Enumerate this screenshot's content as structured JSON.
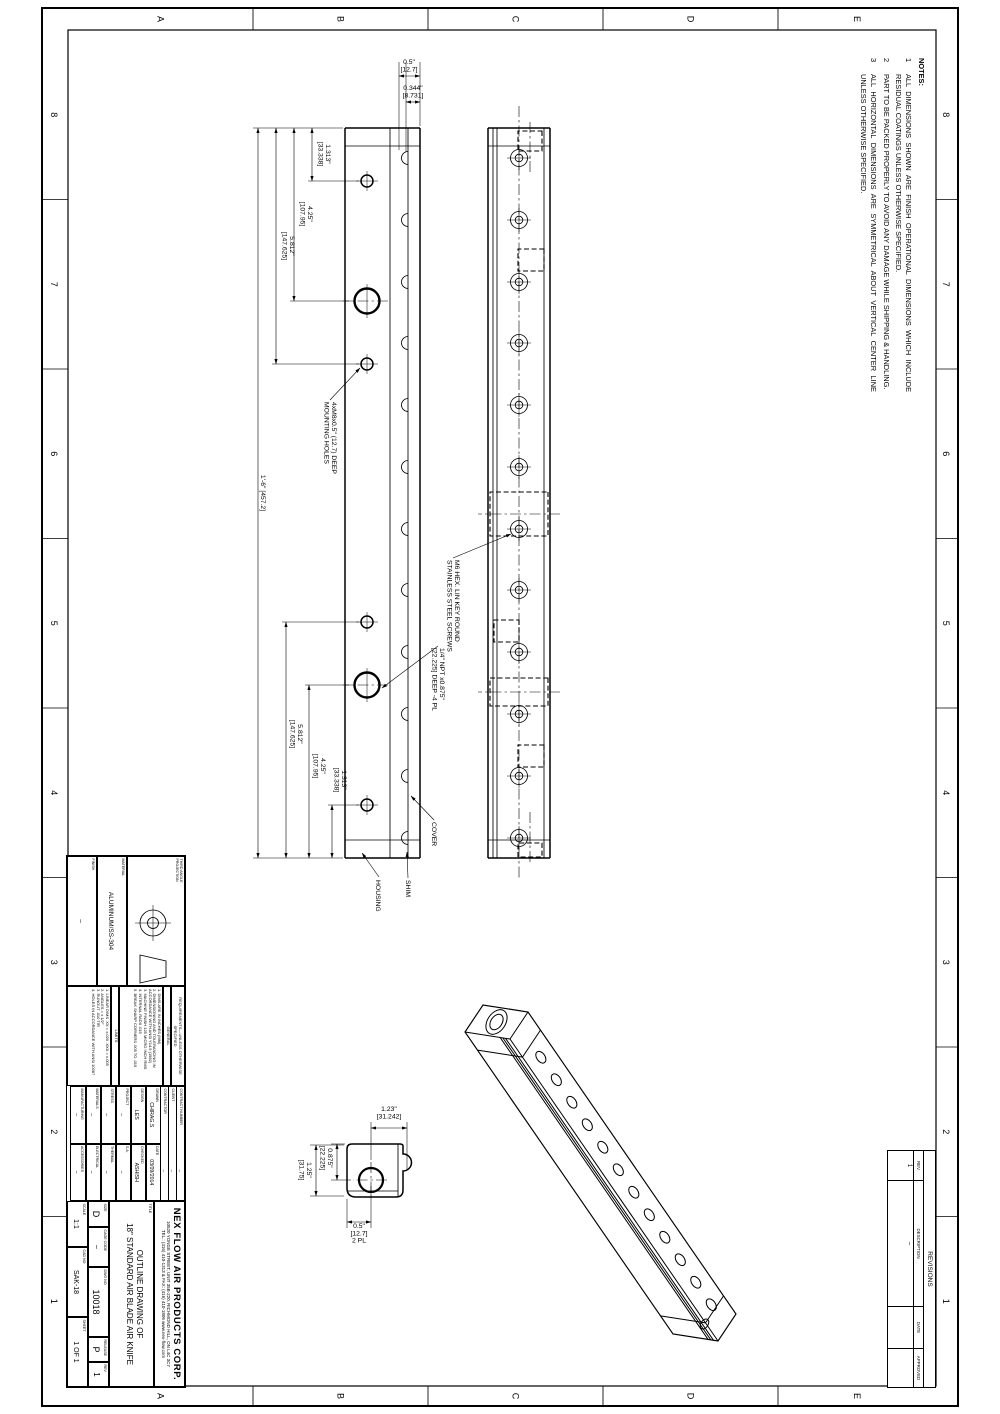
{
  "zones": {
    "columns": [
      "8",
      "7",
      "6",
      "5",
      "4",
      "3",
      "2",
      "1"
    ],
    "rows": [
      "E",
      "D",
      "C",
      "B",
      "A"
    ],
    "col_centers": [
      114.8,
      284.3,
      453.8,
      623.3,
      792.8,
      962.3,
      1131.8,
      1301.3
    ],
    "row_centers": [
      143,
      309.5,
      484.5,
      659.5,
      839.5
    ],
    "col_label_y": [
      57,
      949
    ],
    "row_label_x": [
      19,
      1396
    ]
  },
  "notes": {
    "title": "NOTES:",
    "items": [
      {
        "num": "1",
        "text": "ALL DIMENSIONS SHOWN ARE FINISH OPERATIONAL DIMENSIONS WHICH INCLUDE RESIDUAL COATINGS UNLESS OTHERWISE SPECIFIED."
      },
      {
        "num": "2",
        "text": "PART TO BE PACKED PROPERLY TO AVOID ANY DAMAGE WHILE SHIPPING & HANDLING."
      },
      {
        "num": "3",
        "text": "ALL HORIZONTAL DIMENSIONS ARE SYMMETRICAL ABOUT VERTICAL CENTER LINE UNLESS OTHERWISE SPECIFIED."
      }
    ]
  },
  "revisions": {
    "title": "REVISIONS",
    "headers": [
      "REV",
      "DESCRIPTION",
      "DATE",
      "APPROVED"
    ],
    "rows": [
      [
        "1",
        "–",
        "",
        ""
      ]
    ]
  },
  "title_block": {
    "projection_label": "THIRD ANGLE PROJECTION",
    "material_label": "MATERIAL",
    "material": "ALUMINUM/SS-304",
    "finish_label": "FINISH",
    "finish": "–",
    "req_header": "REQUIREMENTS—UNLESS OTHERWISE SPECIFIED",
    "general_title": "GENERAL",
    "general_items": [
      "1. DIMS ARE IN INCHES (MM)",
      "2. DIMENSIONING AND TOLERANCING IN ACCORDANCE WITH ANSI Y14.5 (1982)",
      "3. MACHINE FINISH 125 MICRO INCH RMS",
      "4. INTERNAL RADII .015",
      "5. BREAK SHARP CORNERS .005 TO .015"
    ],
    "limits_title": "LIMITS",
    "limits_items": [
      "1. LINEAR DIMS  .XX = ±.020  .XXX = ±.005",
      "2. ANGLES = ± 1/2°",
      "3. RUNOUT .010 TIR",
      "4. HOLES IN ACCORDANCE WITH ANSI 10087"
    ],
    "contract_label": "CONTRACT NUMBER",
    "contract": "–",
    "client_label": "CLIENT",
    "client": "–",
    "contractor_label": "CONTRACTOR",
    "contractor": "–",
    "signoff": [
      [
        "DRAWN",
        "CHIRAG.S",
        "DATE",
        "03/09/2014"
      ],
      [
        "DESIGN",
        "LES",
        "CHECKED",
        "ASHISH"
      ],
      [
        "PROJECT",
        "–",
        "S.A.",
        "–"
      ],
      [
        "STRESS",
        "–",
        "THERMAL",
        "–"
      ],
      [
        "MATERIALS",
        "–",
        "ELECTRICAL",
        "–"
      ],
      [
        "MANUFACTURING",
        "–",
        "ACCESSORIES",
        "–"
      ]
    ],
    "company_name": "NEX FLOW AIR PRODUCTS CORP.",
    "company_addr": "10520 YONGE STREET, UNIT 35B-220, RICHMOND HILL, ON L4C 3C7",
    "company_tel": "TEL.: (416) 410-1313 & FAX: (416) 410-1806   www.nex-flow.com",
    "title_label": "TITLE",
    "title_line1": "OUTLINE DRAWING OF",
    "title_line2": "18\" STANDARD AIR BLADE AIR KNIFE",
    "size_label": "SIZE",
    "size": "D",
    "cage_label": "CAGE CODE",
    "cage": "–",
    "dwg_label": "DWG NO",
    "dwg_no": "10018",
    "release_label": "RELEASE",
    "release": "P",
    "rev_label": "REV",
    "rev": "1",
    "scale_label": "SCALE",
    "scale": "1:1",
    "cad_label": "CAD NO",
    "cad_no": "SAK-18",
    "sheet_label": "SHEET",
    "sheet": "1 OF 1"
  },
  "drawing": {
    "dims": [
      {
        "o": "h",
        "a": 128,
        "b": 181,
        "p": 688,
        "t": [
          "1.313\"",
          "[33.338]"
        ],
        "tx": 154,
        "ty": 674
      },
      {
        "o": "h",
        "a": 128,
        "b": 301,
        "p": 706,
        "t": [
          "4.25\"",
          "[107.95]"
        ],
        "tx": 214,
        "ty": 692
      },
      {
        "o": "h",
        "a": 128,
        "b": 364,
        "p": 724,
        "t": [
          "5.812\"",
          "[147.625]"
        ],
        "tx": 246,
        "ty": 710
      },
      {
        "o": "h",
        "a": 805,
        "b": 858,
        "p": 668,
        "t": [
          "1.313\"",
          "[33.338]"
        ],
        "tx": 780,
        "ty": 658
      },
      {
        "o": "h",
        "a": 685,
        "b": 858,
        "p": 691,
        "t": [
          "4.25\"",
          "[107.95]"
        ],
        "tx": 766,
        "ty": 679
      },
      {
        "o": "h",
        "a": 622,
        "b": 858,
        "p": 714,
        "t": [
          "5.812\"",
          "[147.625]"
        ],
        "tx": 734,
        "ty": 702
      },
      {
        "o": "h",
        "a": 128,
        "b": 858,
        "p": 742,
        "t": [
          "1'-6\" [457.2]"
        ],
        "tx": 493,
        "ty": 739
      },
      {
        "o": "h",
        "a": 1144,
        "b": 1180,
        "p": 663,
        "t": [
          "0.875\"",
          "[22.225]"
        ],
        "tx": 1158,
        "ty": 672
      },
      {
        "o": "h",
        "a": 1145,
        "b": 1196,
        "p": 684,
        "t": [
          "1.25\"",
          "[31.75]"
        ],
        "tx": 1170,
        "ty": 693
      },
      {
        "o": "v",
        "a": 580,
        "b": 601,
        "p": 76,
        "t": [
          "0.5\"",
          "[12.7]"
        ],
        "tx": 64,
        "ty": 591
      },
      {
        "o": "v",
        "a": 580,
        "b": 594,
        "p": 102,
        "t": [
          "0.344\"",
          "[8.731]"
        ],
        "tx": 90,
        "ty": 587
      },
      {
        "o": "v",
        "a": 593,
        "b": 629,
        "p": 1128,
        "t": [
          "1.23\"",
          "[31.242]"
        ],
        "tx": 1111,
        "ty": 611
      },
      {
        "o": "v",
        "a": 629,
        "b": 653,
        "p": 1222,
        "t": [
          "0.5\"",
          "[12.7]",
          "2 PL"
        ],
        "tx": 1228,
        "ty": 641
      }
    ],
    "leaders": [
      {
        "t": [
          "4xM8x0.5\" (12.7) DEEP",
          "MOUNTING HOLES"
        ],
        "tx": 402,
        "ty": 668,
        "pts": [
          [
            400,
            670
          ],
          [
            368,
            640
          ]
        ]
      },
      {
        "t": [
          "M6 HEX. LIN KEY ROUND",
          "STAINLESS STEEL SCREWS"
        ],
        "tx": 560,
        "ty": 545,
        "pts": [
          [
            558,
            547
          ],
          [
            534,
            489
          ]
        ]
      },
      {
        "t": [
          "1/4\" NPT x0.875\"",
          "[22.225] DEEP  -4 PL"
        ],
        "tx": 648,
        "ty": 560,
        "pts": [
          [
            646,
            562
          ],
          [
            688,
            618
          ]
        ]
      },
      {
        "t": [
          "COVER"
        ],
        "tx": 822,
        "ty": 568,
        "pts": [
          [
            820,
            566
          ],
          [
            796,
            589
          ]
        ]
      },
      {
        "t": [
          "SHIM"
        ],
        "tx": 880,
        "ty": 594,
        "pts": [
          [
            878,
            592
          ],
          [
            852,
            593
          ]
        ]
      },
      {
        "t": [
          "HOUSING"
        ],
        "tx": 880,
        "ty": 624,
        "pts": [
          [
            877,
            621
          ],
          [
            853,
            638
          ]
        ]
      }
    ]
  },
  "geometry": {
    "border": {
      "outer": [
        8,
        42,
        1398,
        916
      ],
      "inner": [
        30,
        64,
        1356,
        868
      ],
      "col_ticks": [
        199.5,
        369,
        538.5,
        708,
        877.5,
        1047,
        1216.5
      ],
      "row_ticks": [
        222,
        397,
        572,
        747
      ]
    },
    "lines": {
      "o": [
        [
          128,
          450,
          858,
          450
        ],
        [
          128,
          512,
          858,
          512
        ],
        [
          128,
          450,
          128,
          512
        ],
        [
          858,
          450,
          858,
          512
        ],
        [
          128,
          580,
          858,
          580
        ],
        [
          128,
          655,
          858,
          655
        ],
        [
          128,
          580,
          128,
          655
        ],
        [
          858,
          580,
          858,
          655
        ]
      ],
      "t": [
        [
          128,
          456,
          858,
          456
        ],
        [
          128,
          503,
          858,
          503
        ],
        [
          128,
          507,
          858,
          507
        ],
        [
          146,
          450,
          146,
          512
        ],
        [
          840,
          450,
          840,
          512
        ],
        [
          128,
          592,
          858,
          592
        ],
        [
          128,
          610,
          858,
          610
        ],
        [
          146,
          580,
          146,
          655
        ],
        [
          840,
          580,
          840,
          655
        ],
        [
          1144,
          602,
          1197,
          602
        ],
        [
          1191,
          602,
          1191,
          653
        ]
      ],
      "e": [
        [
          128,
          657,
          128,
          747
        ],
        [
          181,
          641,
          181,
          692
        ],
        [
          301,
          648,
          301,
          710
        ],
        [
          364,
          641,
          364,
          728
        ],
        [
          858,
          657,
          858,
          747
        ],
        [
          805,
          641,
          805,
          672
        ],
        [
          685,
          648,
          685,
          695
        ],
        [
          622,
          641,
          622,
          718
        ],
        [
          62,
          580,
          126,
          580
        ],
        [
          62,
          601,
          150,
          601
        ],
        [
          62,
          594,
          152,
          594
        ],
        [
          1122,
          593,
          1170,
          593
        ],
        [
          1122,
          629,
          1160,
          629
        ],
        [
          1144,
          655,
          1144,
          669
        ],
        [
          1180,
          649,
          1180,
          669
        ],
        [
          1145,
          656,
          1145,
          690
        ],
        [
          1196,
          656,
          1196,
          690
        ],
        [
          1186,
          629,
          1228,
          629
        ],
        [
          1199,
          653,
          1228,
          653
        ]
      ],
      "cl": [
        [
          106,
          481,
          880,
          481
        ],
        [
          122,
          470,
          174,
          470
        ],
        [
          812,
          470,
          864,
          470
        ],
        [
          514,
          440,
          514,
          522
        ],
        [
          692,
          440,
          692,
          522
        ],
        [
          301,
          612,
          301,
          657
        ],
        [
          685,
          612,
          685,
          657
        ],
        [
          1162,
          629,
          1198,
          629
        ],
        [
          1180,
          613,
          1180,
          647
        ]
      ]
    },
    "hidden_rects": [
      [
        131,
        458,
        20,
        24
      ],
      [
        249,
        456,
        22,
        26
      ],
      [
        492,
        452,
        44,
        58
      ],
      [
        620,
        481,
        22,
        25
      ],
      [
        678,
        452,
        28,
        58
      ],
      [
        745,
        456,
        22,
        26
      ],
      [
        843,
        458,
        14,
        24
      ]
    ],
    "view_front": {
      "screw_xs": [
        158,
        220,
        282,
        343,
        405,
        467,
        529,
        590,
        652,
        714,
        776,
        838
      ],
      "y": 481,
      "r1": 8.5,
      "r2": 3.8
    },
    "view_top": {
      "bump_y": 592,
      "bump_r": 6.5,
      "hole_y": 633,
      "small": [
        181,
        364,
        622,
        805
      ],
      "small_r": 6,
      "big": [
        301,
        685
      ],
      "big_r": 12.5
    },
    "detail_path": "M 1146 597 L 1154 597 A 8.5 8.5 0 0 1 1171 597 L 1190 597 Q 1197 597 1197 604 L 1197 644 Q 1197 653 1188 653 L 1149 653 Q 1144 653 1144 648 L 1144 600 Q 1144 597 1146 597 Z",
    "iso": {
      "A": [
        1012,
        472
      ],
      "L": [
        302,
        -208
      ],
      "W": [
        27,
        18
      ],
      "H": [
        -7,
        45
      ],
      "holes": {
        "t0": 0.105,
        "dt": 0.0745,
        "n": 12,
        "rx": 6.5,
        "ry": 4.2
      },
      "seams": [
        0.06,
        0.94
      ],
      "grooves": [
        0.1,
        0.16,
        0.22
      ],
      "port": {
        "rx": 13.5,
        "ry": 9,
        "irx": 8.5,
        "iry": 5.6
      }
    }
  }
}
